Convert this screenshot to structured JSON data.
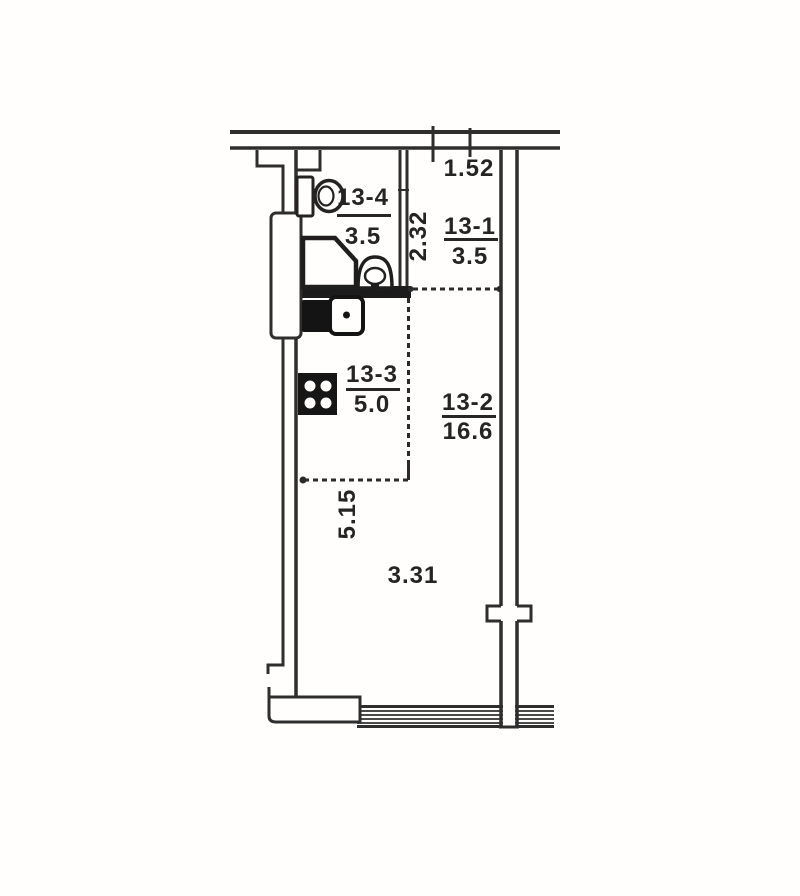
{
  "document_type": "apartment floor plan (scanned)",
  "colors": {
    "ink": "#2e2e2e",
    "paper": "#fffefd",
    "text": "#242424",
    "fill_dark": "#161616"
  },
  "rooms": [
    {
      "id": "13-4",
      "area": "3.5"
    },
    {
      "id": "13-1",
      "area": "3.5"
    },
    {
      "id": "13-3",
      "area": "5.0"
    },
    {
      "id": "13-2",
      "area": "16.6"
    }
  ],
  "dimensions": [
    {
      "value": "1.52",
      "orientation": "horizontal"
    },
    {
      "value": "2.32",
      "orientation": "vertical"
    },
    {
      "value": "5.15",
      "orientation": "vertical"
    },
    {
      "value": "3.31",
      "orientation": "horizontal"
    }
  ],
  "fixtures": [
    {
      "icon": "toilet-icon"
    },
    {
      "icon": "shower-tray-icon"
    },
    {
      "icon": "washbasin-icon"
    },
    {
      "icon": "kitchen-sink-icon"
    },
    {
      "icon": "stove-icon"
    }
  ]
}
